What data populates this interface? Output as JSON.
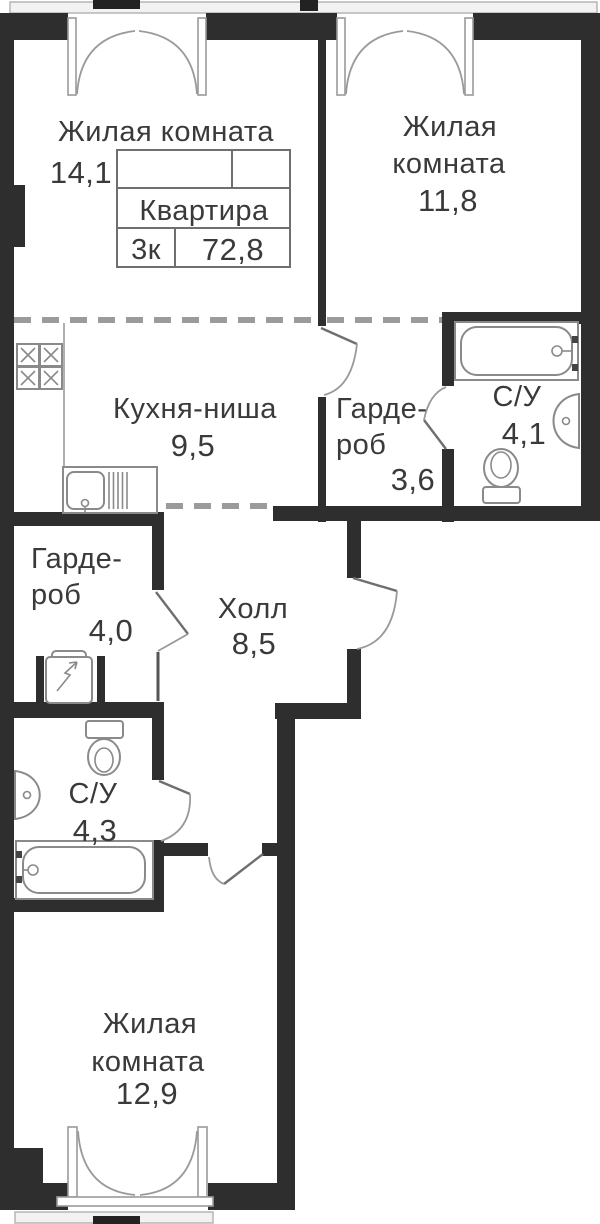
{
  "plan": {
    "info_table": {
      "name_label": "Квартира",
      "rooms_label": "3к",
      "total_area": "72,8"
    },
    "rooms": {
      "room_top_left": {
        "label": "Жилая комната",
        "area": "14,1"
      },
      "room_top_right": {
        "label_line1": "Жилая",
        "label_line2": "комната",
        "area": "11,8"
      },
      "kitchen": {
        "label": "Кухня-ниша",
        "area": "9,5"
      },
      "wardrobe_top": {
        "label_line1": "Гарде-",
        "label_line2": "роб",
        "area": "3,6"
      },
      "bathroom_top": {
        "label": "С/У",
        "area": "4,1"
      },
      "wardrobe_left": {
        "label_line1": "Гарде-",
        "label_line2": "роб",
        "area": "4,0"
      },
      "hall": {
        "label": "Холл",
        "area": "8,5"
      },
      "bathroom_bottom": {
        "label": "С/У",
        "area": "4,3"
      },
      "room_bottom": {
        "label_line1": "Жилая",
        "label_line2": "комната",
        "area": "12,9"
      }
    },
    "icons": [
      "stove-icon",
      "kitchen-sink-icon",
      "water-heater-icon",
      "toilet-icon",
      "washbasin-icon",
      "bathtub-icon",
      "french-door-icon",
      "door-swing-icon",
      "window-band-icon"
    ],
    "colors": {
      "wall": "#2e2e2e",
      "fixture_line": "#8a8a8a",
      "dashed_boundary": "#9b9b9b",
      "text": "#3a3a3a"
    }
  }
}
